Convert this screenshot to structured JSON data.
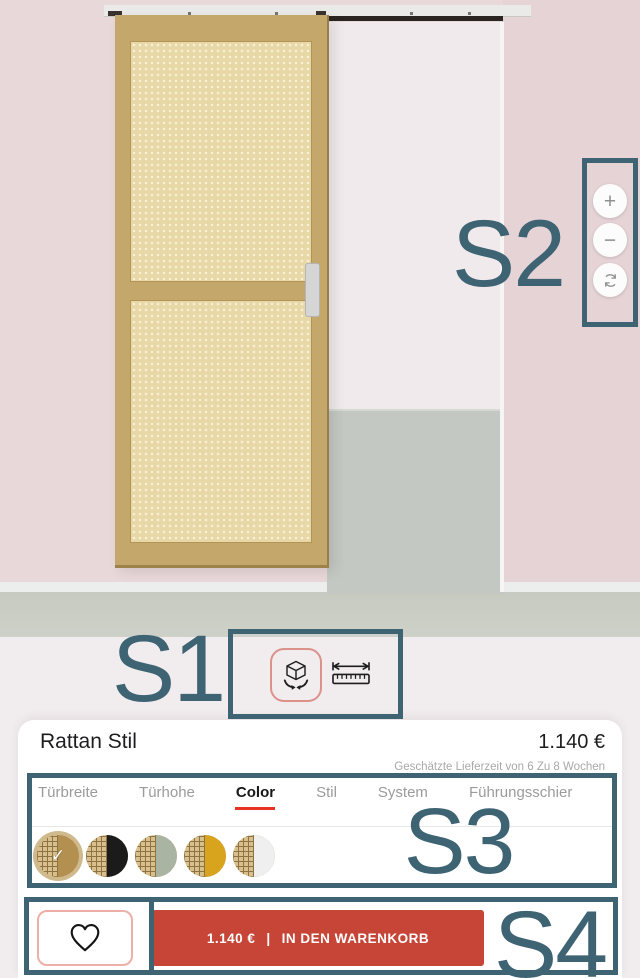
{
  "annotations": {
    "s1": "S1",
    "s2": "S2",
    "s3": "S3",
    "s4": "S4"
  },
  "viewer": {
    "zoom_in": "+",
    "zoom_out": "−",
    "reset_icon": "sync-arrows",
    "mode_3d_icon": "rotate-cube-3d",
    "mode_measure_icon": "ruler-dimensions"
  },
  "product": {
    "title": "Rattan Stil",
    "price": "1.140 €",
    "delivery_note": "Geschätzte Lieferzeit von 6 Zu 8 Wochen"
  },
  "tabs": [
    {
      "label": "Türbreite",
      "active": false
    },
    {
      "label": "Türhohe",
      "active": false
    },
    {
      "label": "Color",
      "active": true
    },
    {
      "label": "Stil",
      "active": false
    },
    {
      "label": "System",
      "active": false
    },
    {
      "label": "Führungsschier",
      "active": false
    }
  ],
  "swatches": [
    {
      "name": "rattan-natural",
      "color": "#b3904f",
      "selected": true,
      "check": "✓"
    },
    {
      "name": "rattan-black",
      "color": "#1b1b1b",
      "selected": false,
      "check": "✓"
    },
    {
      "name": "rattan-sage",
      "color": "#a9b5a2",
      "selected": false,
      "check": "✓"
    },
    {
      "name": "rattan-mustard",
      "color": "#d8a31d",
      "selected": false,
      "check": "✓"
    },
    {
      "name": "rattan-white",
      "color": "#efefef",
      "selected": false,
      "check": "✓"
    }
  ],
  "cart": {
    "price": "1.140 €",
    "separator": "|",
    "label": "IN DEN WARENKORB"
  },
  "colors": {
    "annotation": "#3e6373",
    "cta_red": "#c64537",
    "tab_underline": "#e63323",
    "selected_mode_outline": "#dc9189",
    "wall_pink": "#e9d8da",
    "floor_gray": "#c8ccc4",
    "door_frame": "#c4a76a",
    "rattan": "#e8d8a8"
  }
}
